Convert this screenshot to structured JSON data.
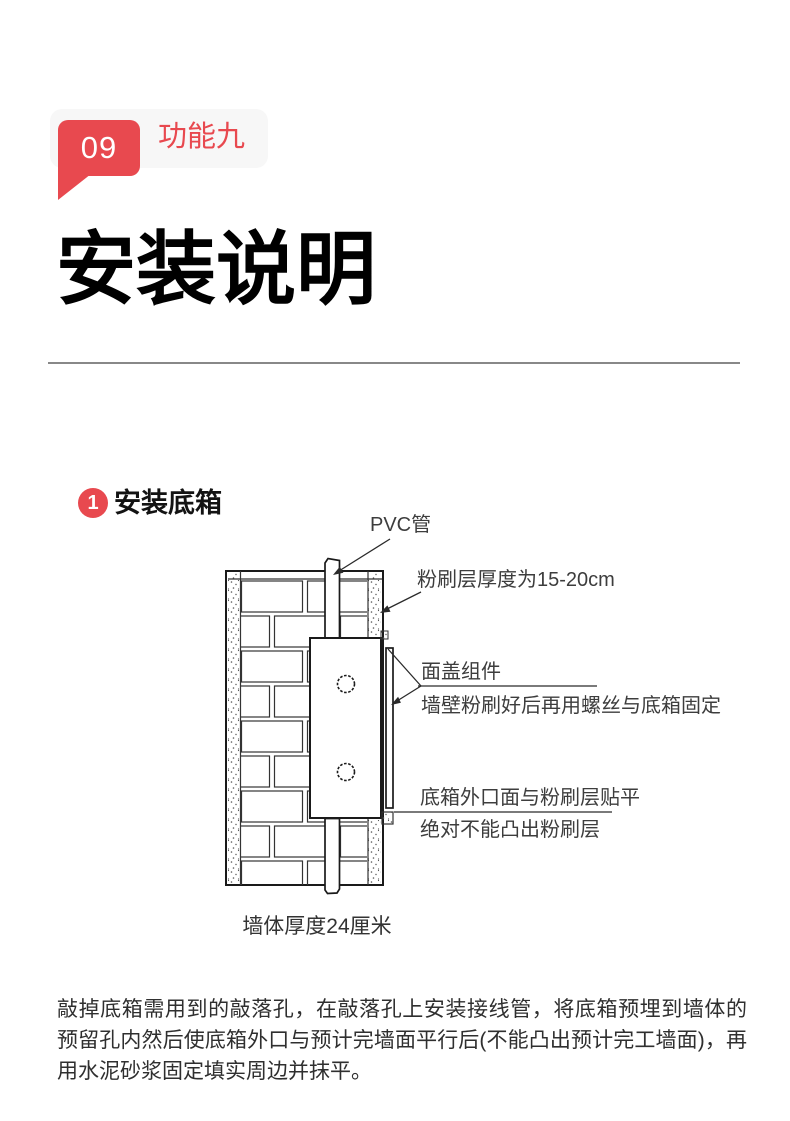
{
  "colors": {
    "accent_red": "#e8494f",
    "pill_bg": "#f7f7f7",
    "divider": "#888888",
    "diagram_line": "#1a1a1a",
    "label_text": "#3d3d3d",
    "body_text": "#2f2f2f"
  },
  "badge": {
    "number": "09",
    "label": "功能九"
  },
  "title": "安装说明",
  "section": {
    "number": "1",
    "title": "安装底箱"
  },
  "diagram": {
    "labels": {
      "pvc_pipe": "PVC管",
      "plaster_thickness": "粉刷层厚度为15-20cm",
      "cover_title": "面盖组件",
      "cover_desc": "墙壁粉刷好后再用螺丝与底箱固定",
      "flush_line1": "底箱外口面与粉刷层贴平",
      "flush_line2": "绝对不能凸出粉刷层",
      "wall_thickness": "墙体厚度24厘米"
    }
  },
  "paragraph": "敲掉底箱需用到的敲落孔，在敲落孔上安装接线管，将底箱预埋到墙体的预留孔内然后使底箱外口与预计完墙面平行后(不能凸出预计完工墙面)，再用水泥砂浆固定填实周边并抹平。"
}
